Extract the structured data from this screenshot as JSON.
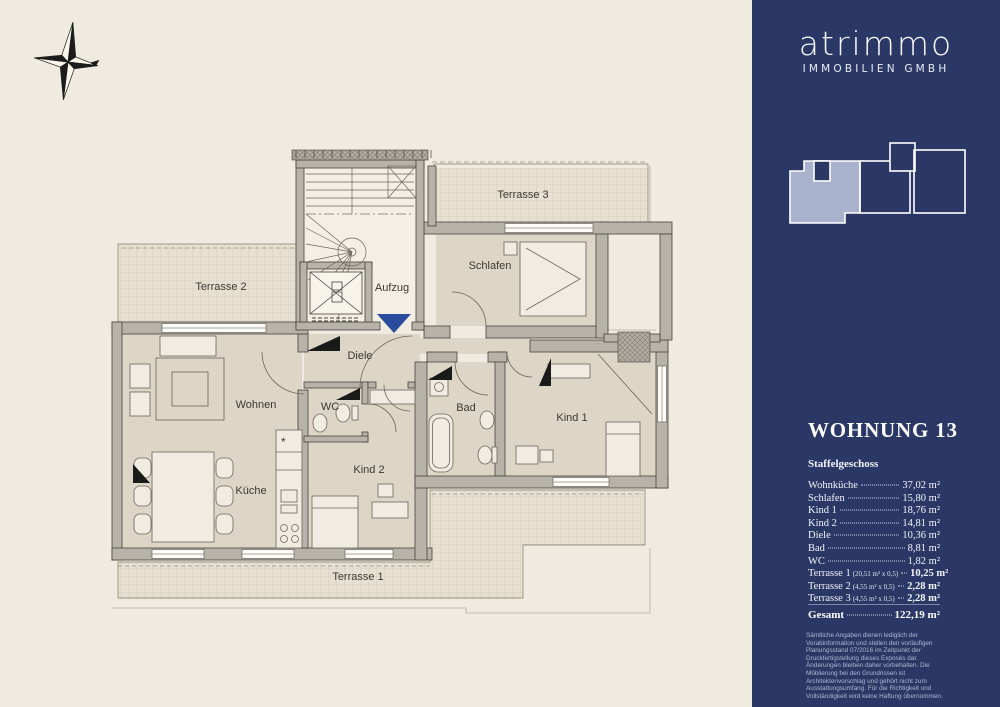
{
  "floorplan": {
    "rooms": [
      {
        "id": "terrasse2",
        "label": "Terrasse 2"
      },
      {
        "id": "terrasse3",
        "label": "Terrasse 3"
      },
      {
        "id": "schlafen",
        "label": "Schlafen"
      },
      {
        "id": "aufzug",
        "label": "Aufzug"
      },
      {
        "id": "diele",
        "label": "Diele"
      },
      {
        "id": "wohnen",
        "label": "Wohnen"
      },
      {
        "id": "wc",
        "label": "WC"
      },
      {
        "id": "kueche",
        "label": "Küche"
      },
      {
        "id": "kind2",
        "label": "Kind 2"
      },
      {
        "id": "bad",
        "label": "Bad"
      },
      {
        "id": "kind1",
        "label": "Kind 1"
      },
      {
        "id": "terrasse1",
        "label": "Terrasse 1"
      }
    ],
    "symbols": {
      "kitchen_star": "*"
    },
    "entrance_color": "#2b4c9c"
  },
  "sidebar": {
    "background": "#2b3866",
    "highlight_color": "#a9b2cc",
    "logo": {
      "name": "atrimmo",
      "subtitle": "IMMOBILIEN GMBH"
    },
    "unit": {
      "title": "WOHNUNG 13",
      "floor": "Staffelgeschoss"
    },
    "areas": [
      {
        "label": "Wohnküche",
        "value": "37,02 m²"
      },
      {
        "label": "Schlafen",
        "value": "15,80 m²"
      },
      {
        "label": "Kind 1",
        "value": "18,76 m²"
      },
      {
        "label": "Kind 2",
        "value": "14,81 m²"
      },
      {
        "label": "Diele",
        "value": "10,36 m²"
      },
      {
        "label": "Bad",
        "value": "8,81 m²"
      },
      {
        "label": "WC",
        "value": "1,82 m²"
      },
      {
        "label": "Terrasse 1",
        "note": "(20,51 m² x 0,5)",
        "value": "10,25 m²"
      },
      {
        "label": "Terrasse 2",
        "note": "(4,55 m² x 0,5)",
        "value": "2,28 m²"
      },
      {
        "label": "Terrasse 3",
        "note": "(4,55 m² x 0,5)",
        "value": "2,28 m²"
      }
    ],
    "total": {
      "label": "Gesamt",
      "value": "122,19 m²"
    },
    "disclaimer": "Sämtliche Angaben dienen lediglich der Vorabinformation und stellen den vorläufigen Planungsstand 07/2016 im Zeitpunkt der Druckfertigstellung dieses Exposés dar. Änderungen bleiben daher vorbehalten. Die Möblierung bei den Grundrissen ist Architektenvorschlag und gehört nicht zum Ausstattungsumfang. Für die Richtigkeit und Vollständigkeit wird keine Haftung übernommen."
  }
}
